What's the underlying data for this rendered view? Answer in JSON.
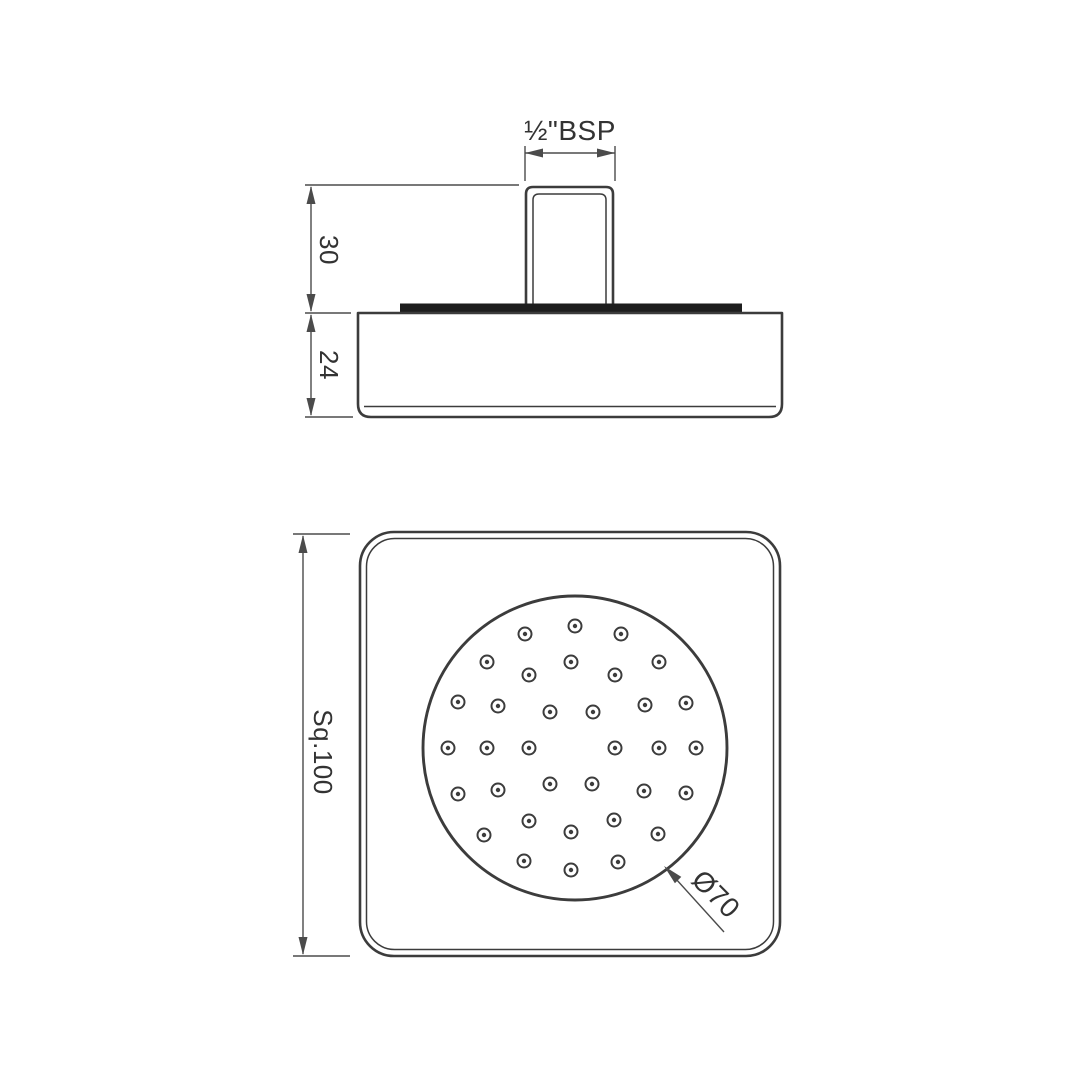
{
  "drawing": {
    "labels": {
      "thread": "½\"BSP",
      "stem_height": "30",
      "body_depth": "24",
      "face_square": "Sq.100",
      "spray_diameter": "Ø70"
    },
    "colors": {
      "object_line": "#3c3c3c",
      "dimension_line": "#4b4b4b",
      "text": "#333333",
      "gasket_fill": "#1e1e1e",
      "background": "#ffffff"
    },
    "nozzle_pattern": {
      "center": [
        575,
        748
      ],
      "face_radius": 152,
      "ring_outer_radius": 6.5,
      "dot_radius": 2.2,
      "count": 34,
      "offsets": [
        [
          0,
          -122
        ],
        [
          -50,
          -114
        ],
        [
          46,
          -114
        ],
        [
          -88,
          -86
        ],
        [
          -4,
          -86
        ],
        [
          84,
          -86
        ],
        [
          -46,
          -73
        ],
        [
          40,
          -73
        ],
        [
          -117,
          -46
        ],
        [
          -77,
          -42
        ],
        [
          70,
          -43
        ],
        [
          111,
          -45
        ],
        [
          -25,
          -36
        ],
        [
          18,
          -36
        ],
        [
          -127,
          0
        ],
        [
          -88,
          0
        ],
        [
          -46,
          0
        ],
        [
          40,
          0
        ],
        [
          84,
          0
        ],
        [
          121,
          0
        ],
        [
          -25,
          36
        ],
        [
          17,
          36
        ],
        [
          -117,
          46
        ],
        [
          -77,
          42
        ],
        [
          69,
          43
        ],
        [
          111,
          45
        ],
        [
          -46,
          73
        ],
        [
          39,
          72
        ],
        [
          -91,
          87
        ],
        [
          -4,
          84
        ],
        [
          83,
          86
        ],
        [
          -51,
          113
        ],
        [
          43,
          114
        ],
        [
          -4,
          122
        ]
      ]
    }
  }
}
